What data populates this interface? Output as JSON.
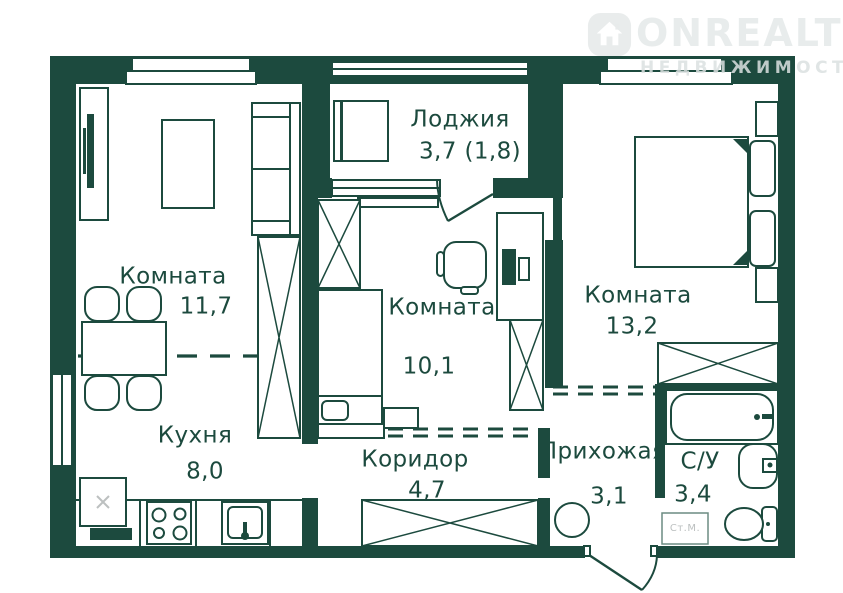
{
  "watermark": {
    "brand": "ONREALT",
    "tagline": "НЕДВИЖИМОСТЬ"
  },
  "colors": {
    "wall": "#1c4a3e",
    "line": "#1c4a3e",
    "muted": "#bcc0c0",
    "watermark_text": "#e7ebeb",
    "watermark_tagline": "#dbe0e0",
    "background": "#ffffff"
  },
  "plan": {
    "rooms": [
      {
        "id": "loggia",
        "name": "Лоджия",
        "area": "3,7 (1,8)"
      },
      {
        "id": "room-a",
        "name": "Комната",
        "area": "11,7"
      },
      {
        "id": "room-b",
        "name": "Комната",
        "area": "10,1"
      },
      {
        "id": "room-c",
        "name": "Комната",
        "area": "13,2"
      },
      {
        "id": "kitchen",
        "name": "Кухня",
        "area": "8,0"
      },
      {
        "id": "corridor",
        "name": "Коридор",
        "area": "4,7"
      },
      {
        "id": "hallway",
        "name": "Прихожая",
        "area": "3,1"
      },
      {
        "id": "bathroom",
        "name": "С/У",
        "area": "3,4"
      }
    ],
    "appliance_labels": {
      "washing_machine": "Ст.М."
    }
  }
}
